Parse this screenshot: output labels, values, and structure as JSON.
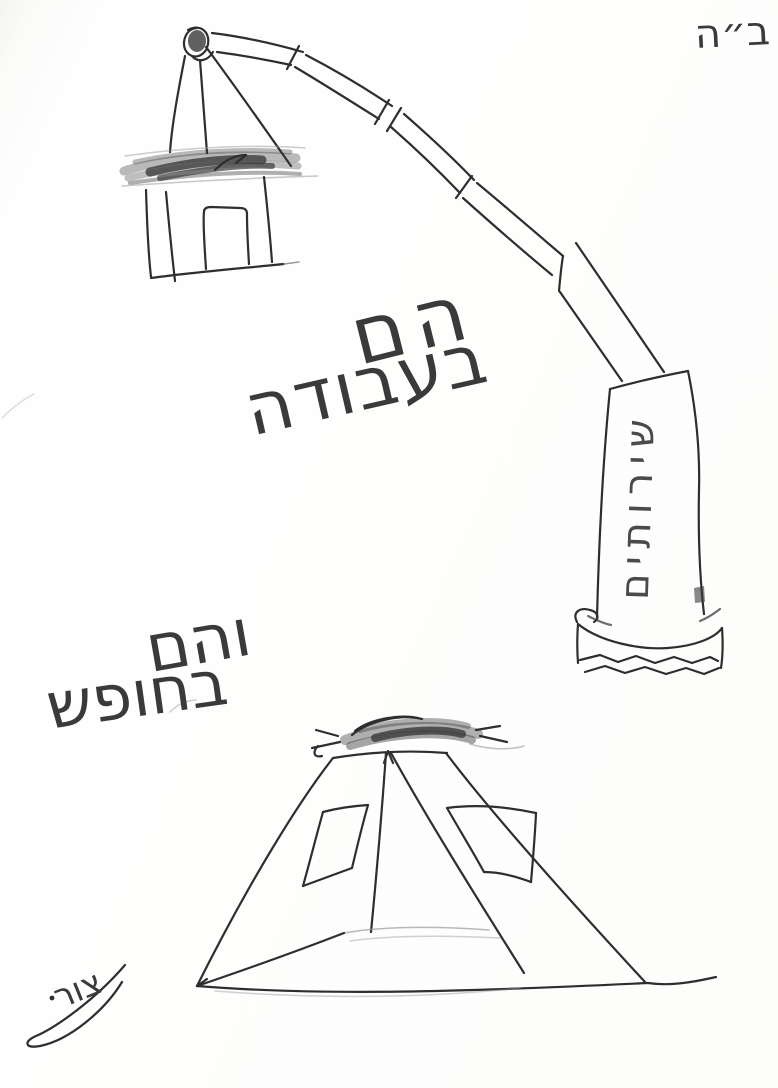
{
  "header": {
    "bh": "ב״ה"
  },
  "captions": {
    "work_line1": "הם",
    "work_line2": "בעבודה",
    "vacation_line1": "והם",
    "vacation_line2": "בחופש"
  },
  "crane": {
    "pillar_label": "שירותים"
  },
  "signature": {
    "text": "צור"
  },
  "colors": {
    "paper": "#fdfdfc",
    "pencil_dark": "#2e2e2e",
    "pencil_mid": "#555555",
    "pencil_light": "#9a9a9a"
  }
}
